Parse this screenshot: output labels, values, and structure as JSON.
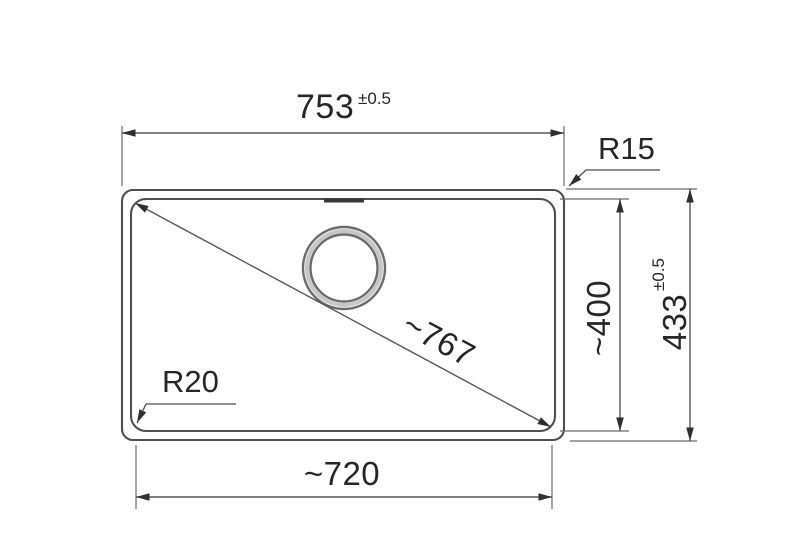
{
  "drawing": {
    "type": "technical-dimension-drawing",
    "colors": {
      "background": "#ffffff",
      "outline": "#4f4f4f",
      "dimension_lines": "#565656",
      "text": "#262626"
    },
    "dims": {
      "width_outer": "753",
      "width_outer_tol": "±0.5",
      "width_inner": "~720",
      "height_inner": "~400",
      "height_outer": "433",
      "height_outer_tol": "±0.5",
      "diagonal": "~767",
      "radius_outer": "R15",
      "radius_inner": "R20"
    }
  }
}
